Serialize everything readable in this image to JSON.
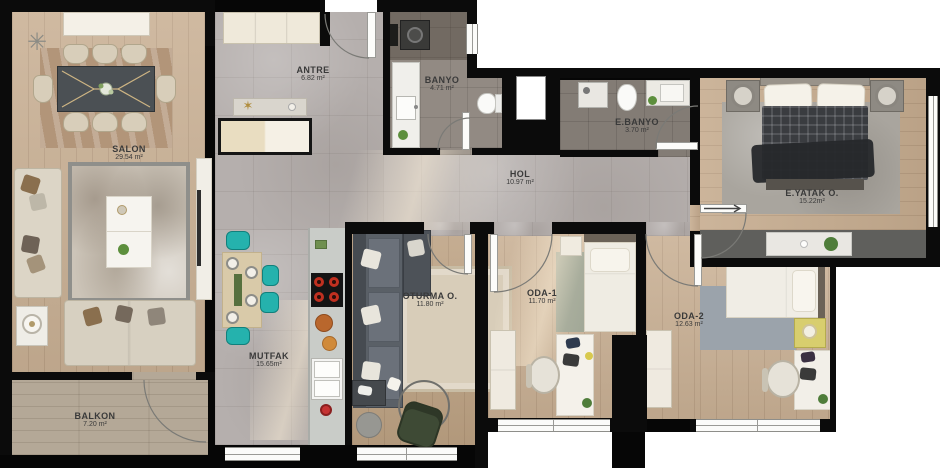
{
  "plan": {
    "type": "apartment-floor-plan",
    "rooms": [
      {
        "name": "SALON",
        "area": "29.54 m²"
      },
      {
        "name": "ANTRE",
        "area": "6.82 m²"
      },
      {
        "name": "BANYO",
        "area": "4.71 m²"
      },
      {
        "name": "E.BANYO",
        "area": "3.70 m²"
      },
      {
        "name": "HOL",
        "area": "10.97 m²"
      },
      {
        "name": "E.YATAK O.",
        "area": "15.22m²"
      },
      {
        "name": "ODA-1",
        "area": "11.70 m²"
      },
      {
        "name": "ODA-2",
        "area": "12.63 m²"
      },
      {
        "name": "OTURMA O.",
        "area": "11.80 m²"
      },
      {
        "name": "MUTFAK",
        "area": "15.65m²"
      },
      {
        "name": "BALKON",
        "area": "7.20 m²"
      }
    ],
    "colors": {
      "background": "#000000",
      "exterior_white": "#ffffff",
      "wall": "#0b0b0b",
      "tile_floor": "#b5afad",
      "wood_floor": "#c9b094",
      "bath_tile": "#837c75",
      "label_text": "#3a3a3a",
      "accent_teal": "#25b2ad",
      "accent_red": "#c53333",
      "accent_yellow": "#d8ce6e",
      "accent_green": "#4f7d3a"
    }
  }
}
